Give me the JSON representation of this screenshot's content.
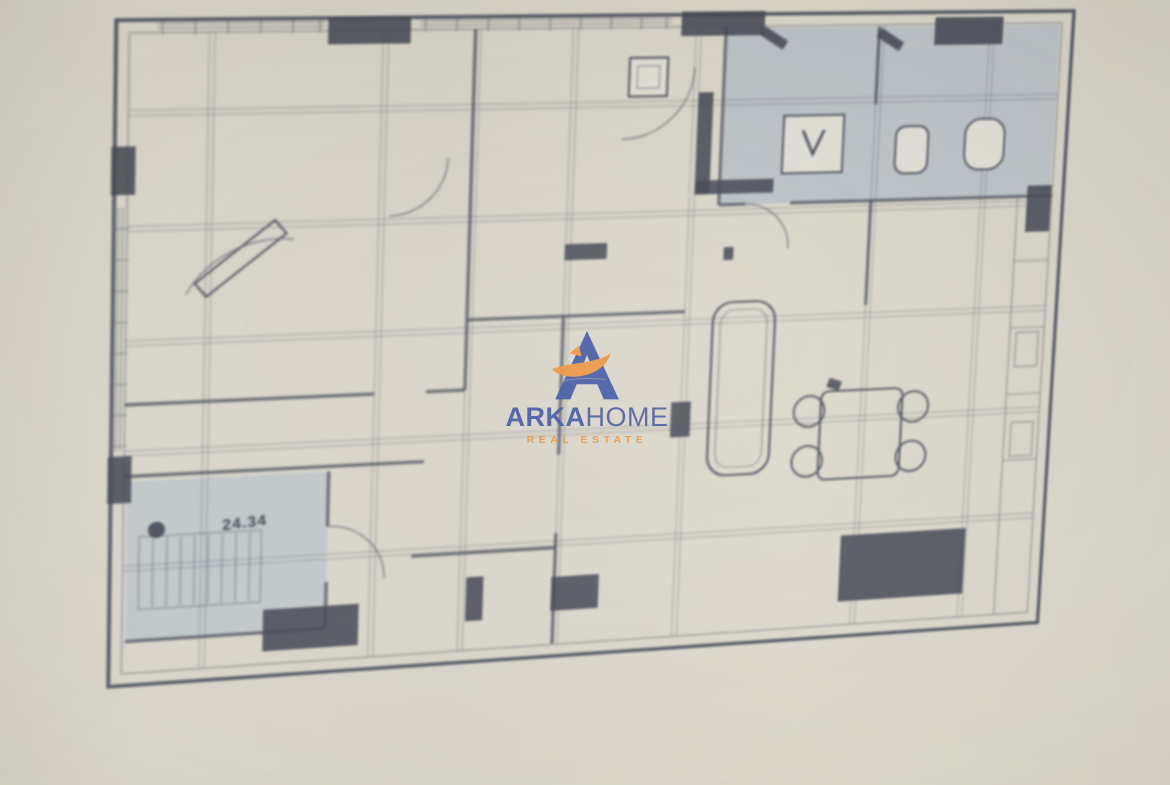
{
  "watermark": {
    "brand_primary": "ARKA",
    "brand_secondary": "HOME",
    "tagline": "REAL ESTATE",
    "logo_blue": "#3a53a4",
    "logo_orange": "#f0923c"
  },
  "plan": {
    "level_marker": "24.34",
    "line_color": "#4a4f5d",
    "wet_area_fill": "#b6c0c8",
    "paper_tone": "#dbd7cc",
    "symbols": [
      "shower",
      "toilet",
      "sink",
      "dining-table",
      "chairs",
      "sofa",
      "stairs",
      "door-swing",
      "structural-columns",
      "window-hatching"
    ]
  }
}
